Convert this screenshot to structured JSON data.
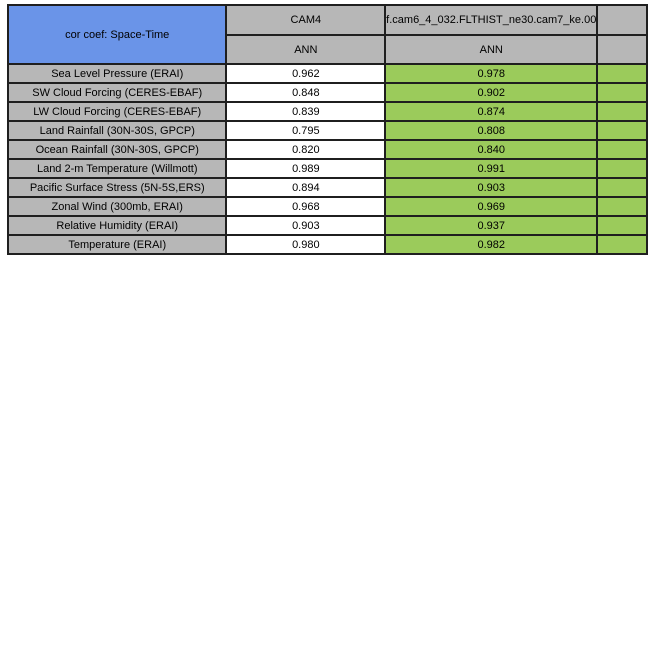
{
  "table": {
    "title": "cor coef: Space-Time",
    "columns": [
      {
        "model": "CAM4",
        "season": "ANN"
      },
      {
        "model": "f.cam6_4_032.FLTHIST_ne30.cam7_ke.00",
        "season": "ANN"
      }
    ],
    "rows": [
      {
        "label": "Sea Level Pressure (ERAI)",
        "values": [
          "0.962",
          "0.978"
        ]
      },
      {
        "label": "SW Cloud Forcing (CERES-EBAF)",
        "values": [
          "0.848",
          "0.902"
        ]
      },
      {
        "label": "LW Cloud Forcing (CERES-EBAF)",
        "values": [
          "0.839",
          "0.874"
        ]
      },
      {
        "label": "Land Rainfall (30N-30S, GPCP)",
        "values": [
          "0.795",
          "0.808"
        ]
      },
      {
        "label": "Ocean Rainfall (30N-30S, GPCP)",
        "values": [
          "0.820",
          "0.840"
        ]
      },
      {
        "label": "Land 2-m Temperature (Willmott)",
        "values": [
          "0.989",
          "0.991"
        ]
      },
      {
        "label": "Pacific Surface Stress (5N-5S,ERS)",
        "values": [
          "0.894",
          "0.903"
        ]
      },
      {
        "label": "Zonal Wind (300mb, ERAI)",
        "values": [
          "0.968",
          "0.969"
        ]
      },
      {
        "label": "Relative Humidity (ERAI)",
        "values": [
          "0.903",
          "0.937"
        ]
      },
      {
        "label": "Temperature (ERAI)",
        "values": [
          "0.980",
          "0.982"
        ]
      }
    ],
    "colors": {
      "title_bg": "#6A94E8",
      "header_bg": "#B7B7B7",
      "row_label_bg": "#B7B7B7",
      "baseline_value_bg": "#FFFFFF",
      "test_value_bg": "#9BCB5B",
      "border": "#1F1F1F"
    }
  },
  "chart_data": {
    "type": "table",
    "title": "cor coef: Space-Time",
    "columns": [
      "CAM4 (ANN)",
      "f.cam6_4_032.FLTHIST_ne30.cam7_ke.00 (ANN)"
    ],
    "categories": [
      "Sea Level Pressure (ERAI)",
      "SW Cloud Forcing (CERES-EBAF)",
      "LW Cloud Forcing (CERES-EBAF)",
      "Land Rainfall (30N-30S, GPCP)",
      "Ocean Rainfall (30N-30S, GPCP)",
      "Land 2-m Temperature (Willmott)",
      "Pacific Surface Stress (5N-5S,ERS)",
      "Zonal Wind (300mb, ERAI)",
      "Relative Humidity (ERAI)",
      "Temperature (ERAI)"
    ],
    "series": [
      {
        "name": "CAM4",
        "values": [
          0.962,
          0.848,
          0.839,
          0.795,
          0.82,
          0.989,
          0.894,
          0.968,
          0.903,
          0.98
        ]
      },
      {
        "name": "f.cam6_4_032.FLTHIST_ne30.cam7_ke.00",
        "values": [
          0.978,
          0.902,
          0.874,
          0.808,
          0.84,
          0.991,
          0.903,
          0.969,
          0.937,
          0.982
        ]
      }
    ]
  }
}
